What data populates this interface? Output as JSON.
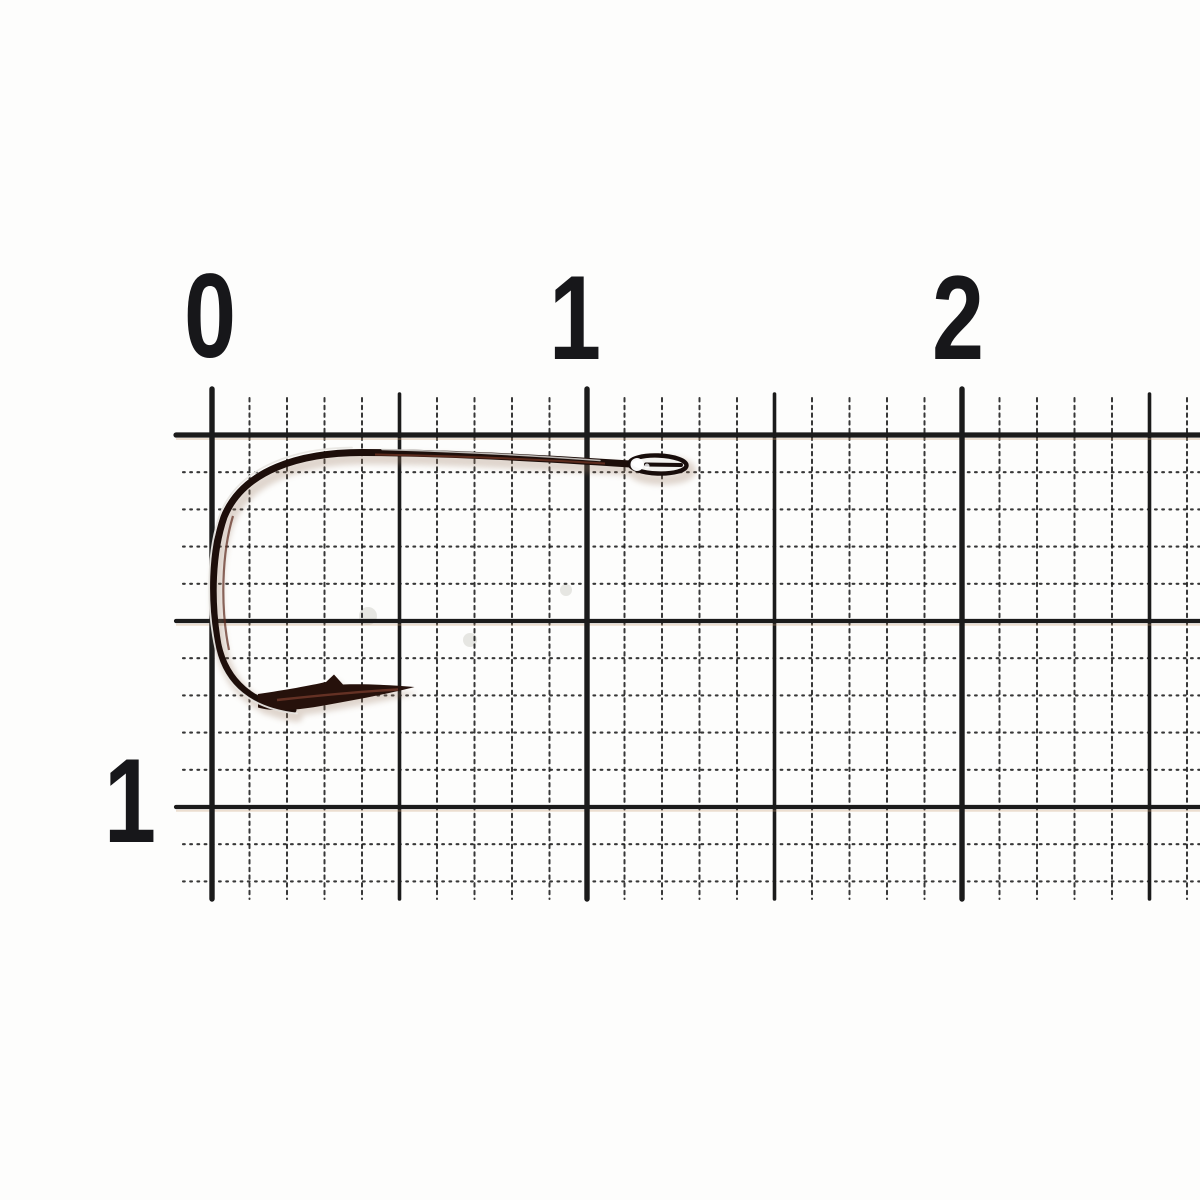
{
  "scene": {
    "description": "Macro photo of a single bronze fishing hook lying on white millimeter graph paper with a centimeter ruler scale",
    "background_color": "#fdfdfc",
    "paper_color": "#fdfdfc"
  },
  "ruler": {
    "unit": "cm",
    "top_labels": [
      {
        "text": "0",
        "x": 210,
        "y": 316
      },
      {
        "text": "1",
        "x": 575,
        "y": 318
      },
      {
        "text": "2",
        "x": 958,
        "y": 318
      }
    ],
    "side_labels": [
      {
        "text": "1",
        "x": 130,
        "y": 801
      }
    ],
    "text_color": "#17171a",
    "font_px": 120
  },
  "grid": {
    "line_color": "#1b1b1b",
    "fringe_color": "#c89a6e",
    "origin_x": 212,
    "top_y": 435,
    "bottom_y": 899,
    "right_x": 1200,
    "mm_px_x": 37.5,
    "mm_px_y": 37.2,
    "minor_cols_max": 26,
    "minor_rows_max": 12,
    "cm_cols_x": [
      212,
      587,
      962
    ],
    "half_cols_x": [
      399.5,
      774.5,
      1149.5
    ],
    "solid_rows_y": [
      621,
      807
    ],
    "tick_top_cm_y": 389,
    "tick_top_half_y": 394,
    "tick_top_minor_y": 398,
    "tick_left_solid_x": 176,
    "tick_left_minor_x": 183,
    "w_cm": 5.4,
    "w_half": 3.6,
    "w_row_top": 5.2,
    "w_row_solid": 4.2,
    "w_minor": 2.0,
    "dash_minor_v": "3.5 4.2",
    "dash_minor_h": "1.8 5.4"
  },
  "hook": {
    "colors": {
      "wire_dark": "#1d0e0a",
      "point_dark": "#26110b",
      "bronze_stripe": "#6e3322",
      "bend_stripe": "#5d2a1d",
      "point_stripe": "#74392b",
      "highlight": "#e9e7e3",
      "shank_highlight": "#d9d7d3",
      "shadow": "#9b7a62",
      "eye_fill": "#f3f2ef",
      "eye_stroke": "#180d0b",
      "eye_glint": "#ffffff"
    },
    "paths": {
      "wire": "M 630 464 C 540 458 440 452.5 362 452.5 C 300 452.5 243 470 224 517 C 212 552 210 600 218 645 C 226 682 253 705 293 710",
      "point": "M 258 694 C 286 690 310 685.5 326 682 L 334 674.5 L 343 684.5 C 366 683.8 392 685 414.5 687 C 390 693.5 352 700.5 318 706.5 C 298 710 272 712 258 707.5 Z",
      "bend_highlight": "M 352 447.5 C 296 448 240 466 220.5 513 C 207.5 548 205.5 602 215.5 649 C 224 686 252 709 297 713.5",
      "shank_highlight": "M 382 449.5 C 470 452 540 456 600 460.5",
      "stripe_shank": "M 375 454.5 C 460 456 540 459.5 605 463.5",
      "stripe_bend": "M 233 516 C 222 552 220 606 229 650",
      "stripe_point": "M 277 700 C 310 696.5 350 692 398 689.5"
    },
    "eye": {
      "cx": 658,
      "cy": 464.5,
      "rx": 28.5,
      "ry": 9,
      "rotate": 2,
      "slot": {
        "x1": 646,
        "y1": 464.5,
        "x2": 681,
        "y2": 465,
        "w": 4
      },
      "highlight": {
        "cx": 637,
        "cy": 464.5,
        "r": 6.5
      },
      "glint": {
        "cx": 647,
        "cy": 466,
        "r": 2.5
      }
    }
  },
  "paper_marks": {
    "speck_color": "#c9c9c4",
    "specks": [
      {
        "x": 368,
        "y": 616,
        "r": 9
      },
      {
        "x": 470,
        "y": 640,
        "r": 7
      },
      {
        "x": 566,
        "y": 590,
        "r": 6
      }
    ]
  }
}
